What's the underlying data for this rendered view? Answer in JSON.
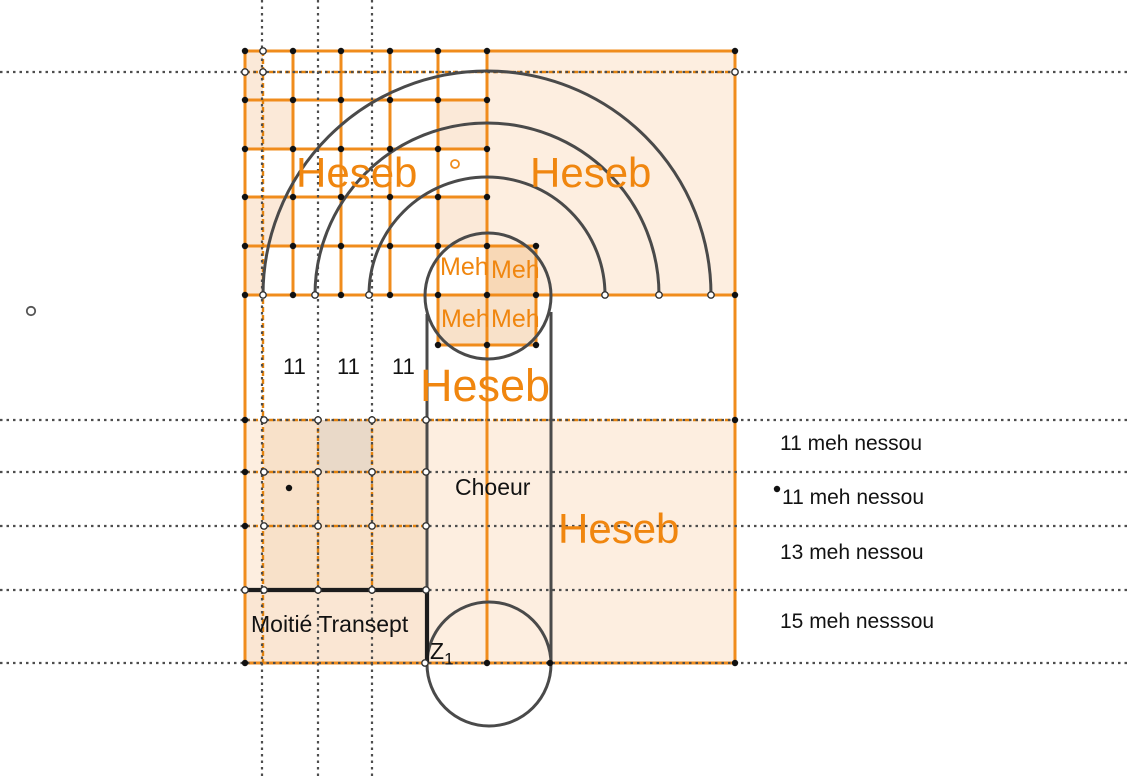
{
  "title": "Geometric analysis of a church plan (choir and transept) with Egyptian cubit grid",
  "labels": {
    "heseb": "Heseb",
    "meh": "Meh",
    "eleven": "11",
    "choeur": "Choeur",
    "moitie_transept": "Moitié Transept",
    "z_point": "Z",
    "z_sub": "1"
  },
  "annotations": [
    {
      "text": "11 meh nessou"
    },
    {
      "text": "11 meh nessou"
    },
    {
      "text": "13 meh nessou"
    },
    {
      "text": "15 meh nesssou"
    }
  ],
  "colors": {
    "orange_line": "#f08c1c",
    "orange_text": "#f0860f",
    "arc_gray": "#4a4a4a",
    "black_line": "#1c1c1c",
    "guide_dot_gray": "#4d4d4d",
    "fill_light_peach": "#fdeee0",
    "fill_grid_peach": "#f8e1c9",
    "fill_meh_dark": "#f8d8b6",
    "fill_gray_tan_cell": "#e9d9c8"
  }
}
